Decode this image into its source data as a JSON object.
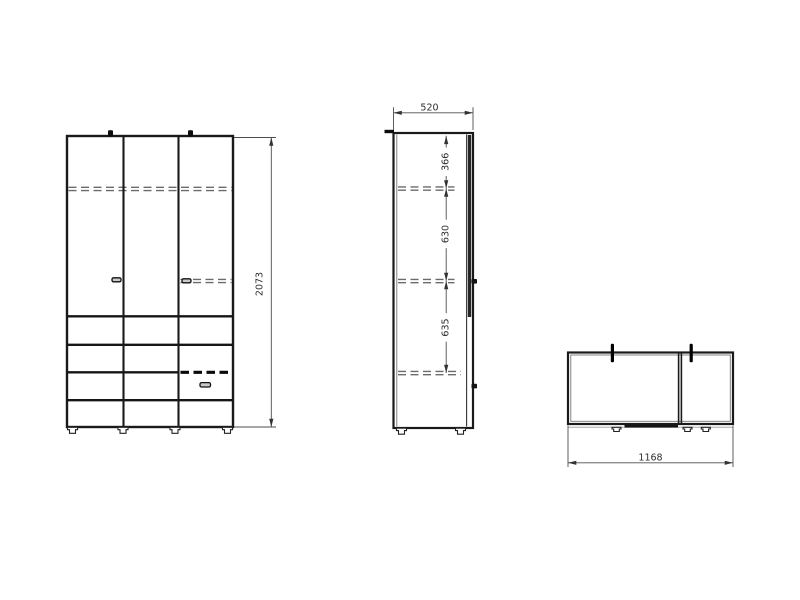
{
  "dimension_labels": {
    "front_height": "2073",
    "side_depth": "520",
    "side_section_top": "366",
    "side_section_middle": "630",
    "side_section_bottom": "635",
    "top_width": "1168"
  }
}
